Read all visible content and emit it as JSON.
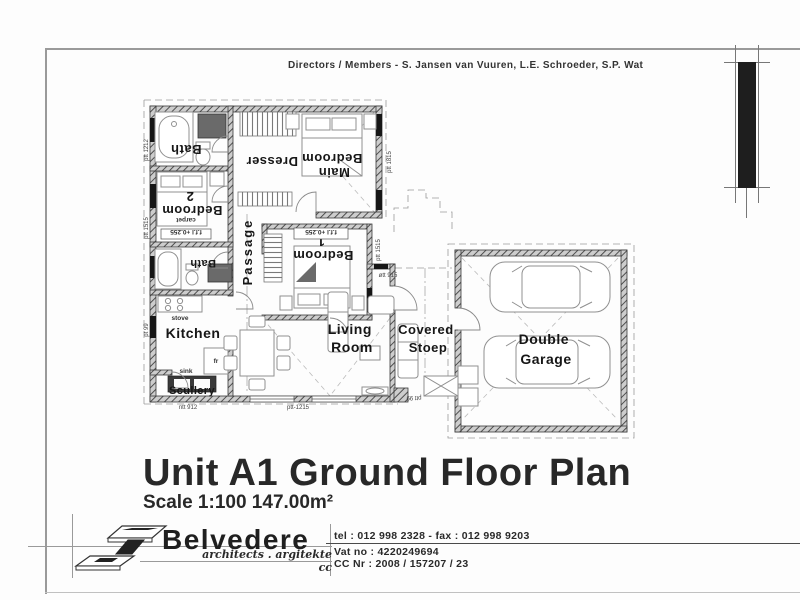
{
  "header": {
    "directors_prefix": "Directors / ",
    "directors_underlined": "Members - S. Jansen van Vuuren, L.E. Schroeder",
    "directors_suffix": ", S.P. Wat"
  },
  "plan": {
    "rooms": {
      "bath1": "Bath",
      "dresser": "Dresser",
      "main_bedroom_line1": "Main",
      "main_bedroom_line2": "Bedroom",
      "bedroom2_line1": "Bedroom",
      "bedroom2_line2": "2",
      "bedroom1_line1": "Bedroom",
      "bedroom1_line2": "1",
      "passage": "Passage",
      "bath2": "Bath",
      "kitchen": "Kitchen",
      "scullery": "Scullery",
      "living_line1": "Living",
      "living_line2": "Room",
      "stoep_line1": "Covered",
      "stoep_line2": "Stoep",
      "garage_line1": "Double",
      "garage_line2": "Garage"
    },
    "fixtures": {
      "stove": "stove",
      "sink": "sink",
      "fridge": "fr",
      "carpet": "carpet"
    },
    "levels": {
      "ffl_bedroom1": "f.f.l +0.255",
      "ffl_bedroom2": "f.f.l +0.255"
    },
    "dims": {
      "left_top": "ptt 1212",
      "left_mid": "ptt 1515",
      "left_bottom": "pt 99",
      "wing_right": "ptt 1815",
      "bedroom1_right": "ptt 1515",
      "living_top": "øtt 915",
      "bottom_left": "ntt 912",
      "bottom_mid": "ptt-1215",
      "stoep_bottom": "ptt 99"
    }
  },
  "title": {
    "main": "Unit A1 Ground Floor Plan",
    "scale": "Scale 1:100 147.00m²"
  },
  "footer": {
    "brand": "Belvedere",
    "tagline": "architects . argitekte cc",
    "tel_fax": "tel : 012 998 2328 - fax : 012 998 9203",
    "vat": "Vat no : 4220249694",
    "cc_nr": "CC Nr : 2008 / 157207 / 23"
  }
}
